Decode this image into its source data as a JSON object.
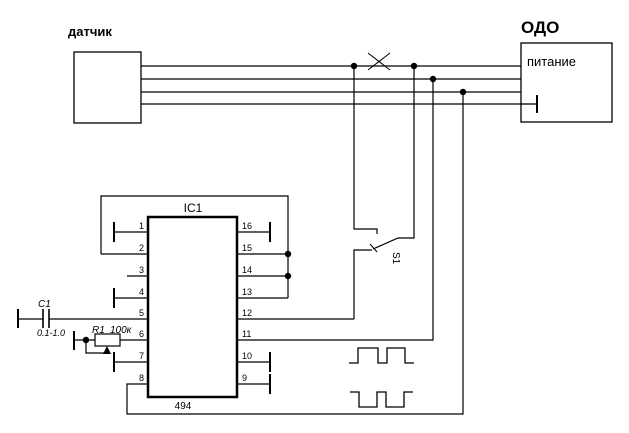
{
  "title_labels": {
    "sensor": "датчик",
    "unit": "ОДО",
    "power": "питание"
  },
  "ic": {
    "name": "IC1",
    "part_number": "494",
    "pins_left": [
      "1",
      "2",
      "3",
      "4",
      "5",
      "6",
      "7",
      "8"
    ],
    "pins_right": [
      "16",
      "15",
      "14",
      "13",
      "12",
      "11",
      "10",
      "9"
    ]
  },
  "components": {
    "capacitor_name": "C1",
    "capacitor_value": "0.1-1.0",
    "resistor_name": "R1",
    "resistor_value": "100к",
    "switch_name": "S1"
  },
  "colors": {
    "line": "#000000",
    "background": "#ffffff"
  }
}
